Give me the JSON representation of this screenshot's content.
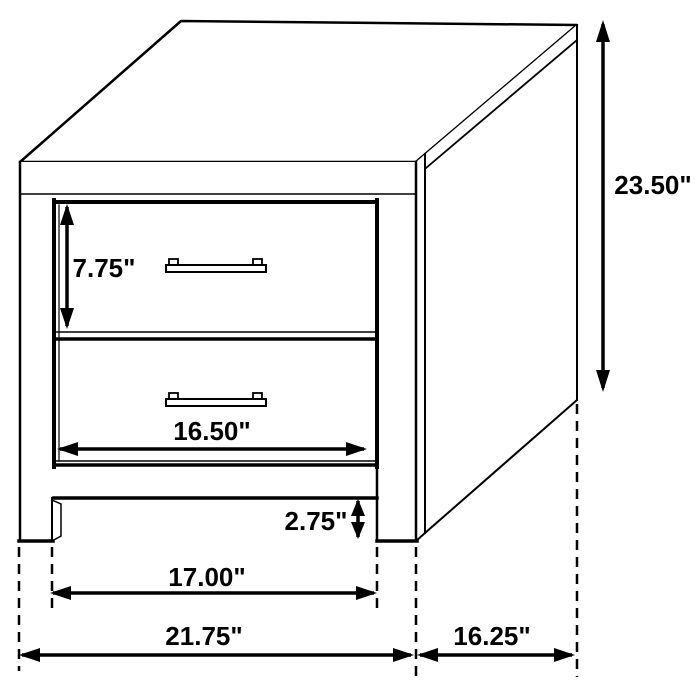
{
  "figure": {
    "kind": "furniture-dimension-diagram",
    "subject": "two-drawer nightstand",
    "units": "inches",
    "background_color": "#ffffff",
    "line_color": "#000000"
  },
  "dimensions": {
    "overall_height": "23.50\"",
    "drawer_front_height": "7.75\"",
    "drawer_width": "16.50\"",
    "base_clearance_height": "2.75\"",
    "inner_leg_span": "17.00\"",
    "overall_width": "21.75\"",
    "overall_depth": "16.25\""
  }
}
